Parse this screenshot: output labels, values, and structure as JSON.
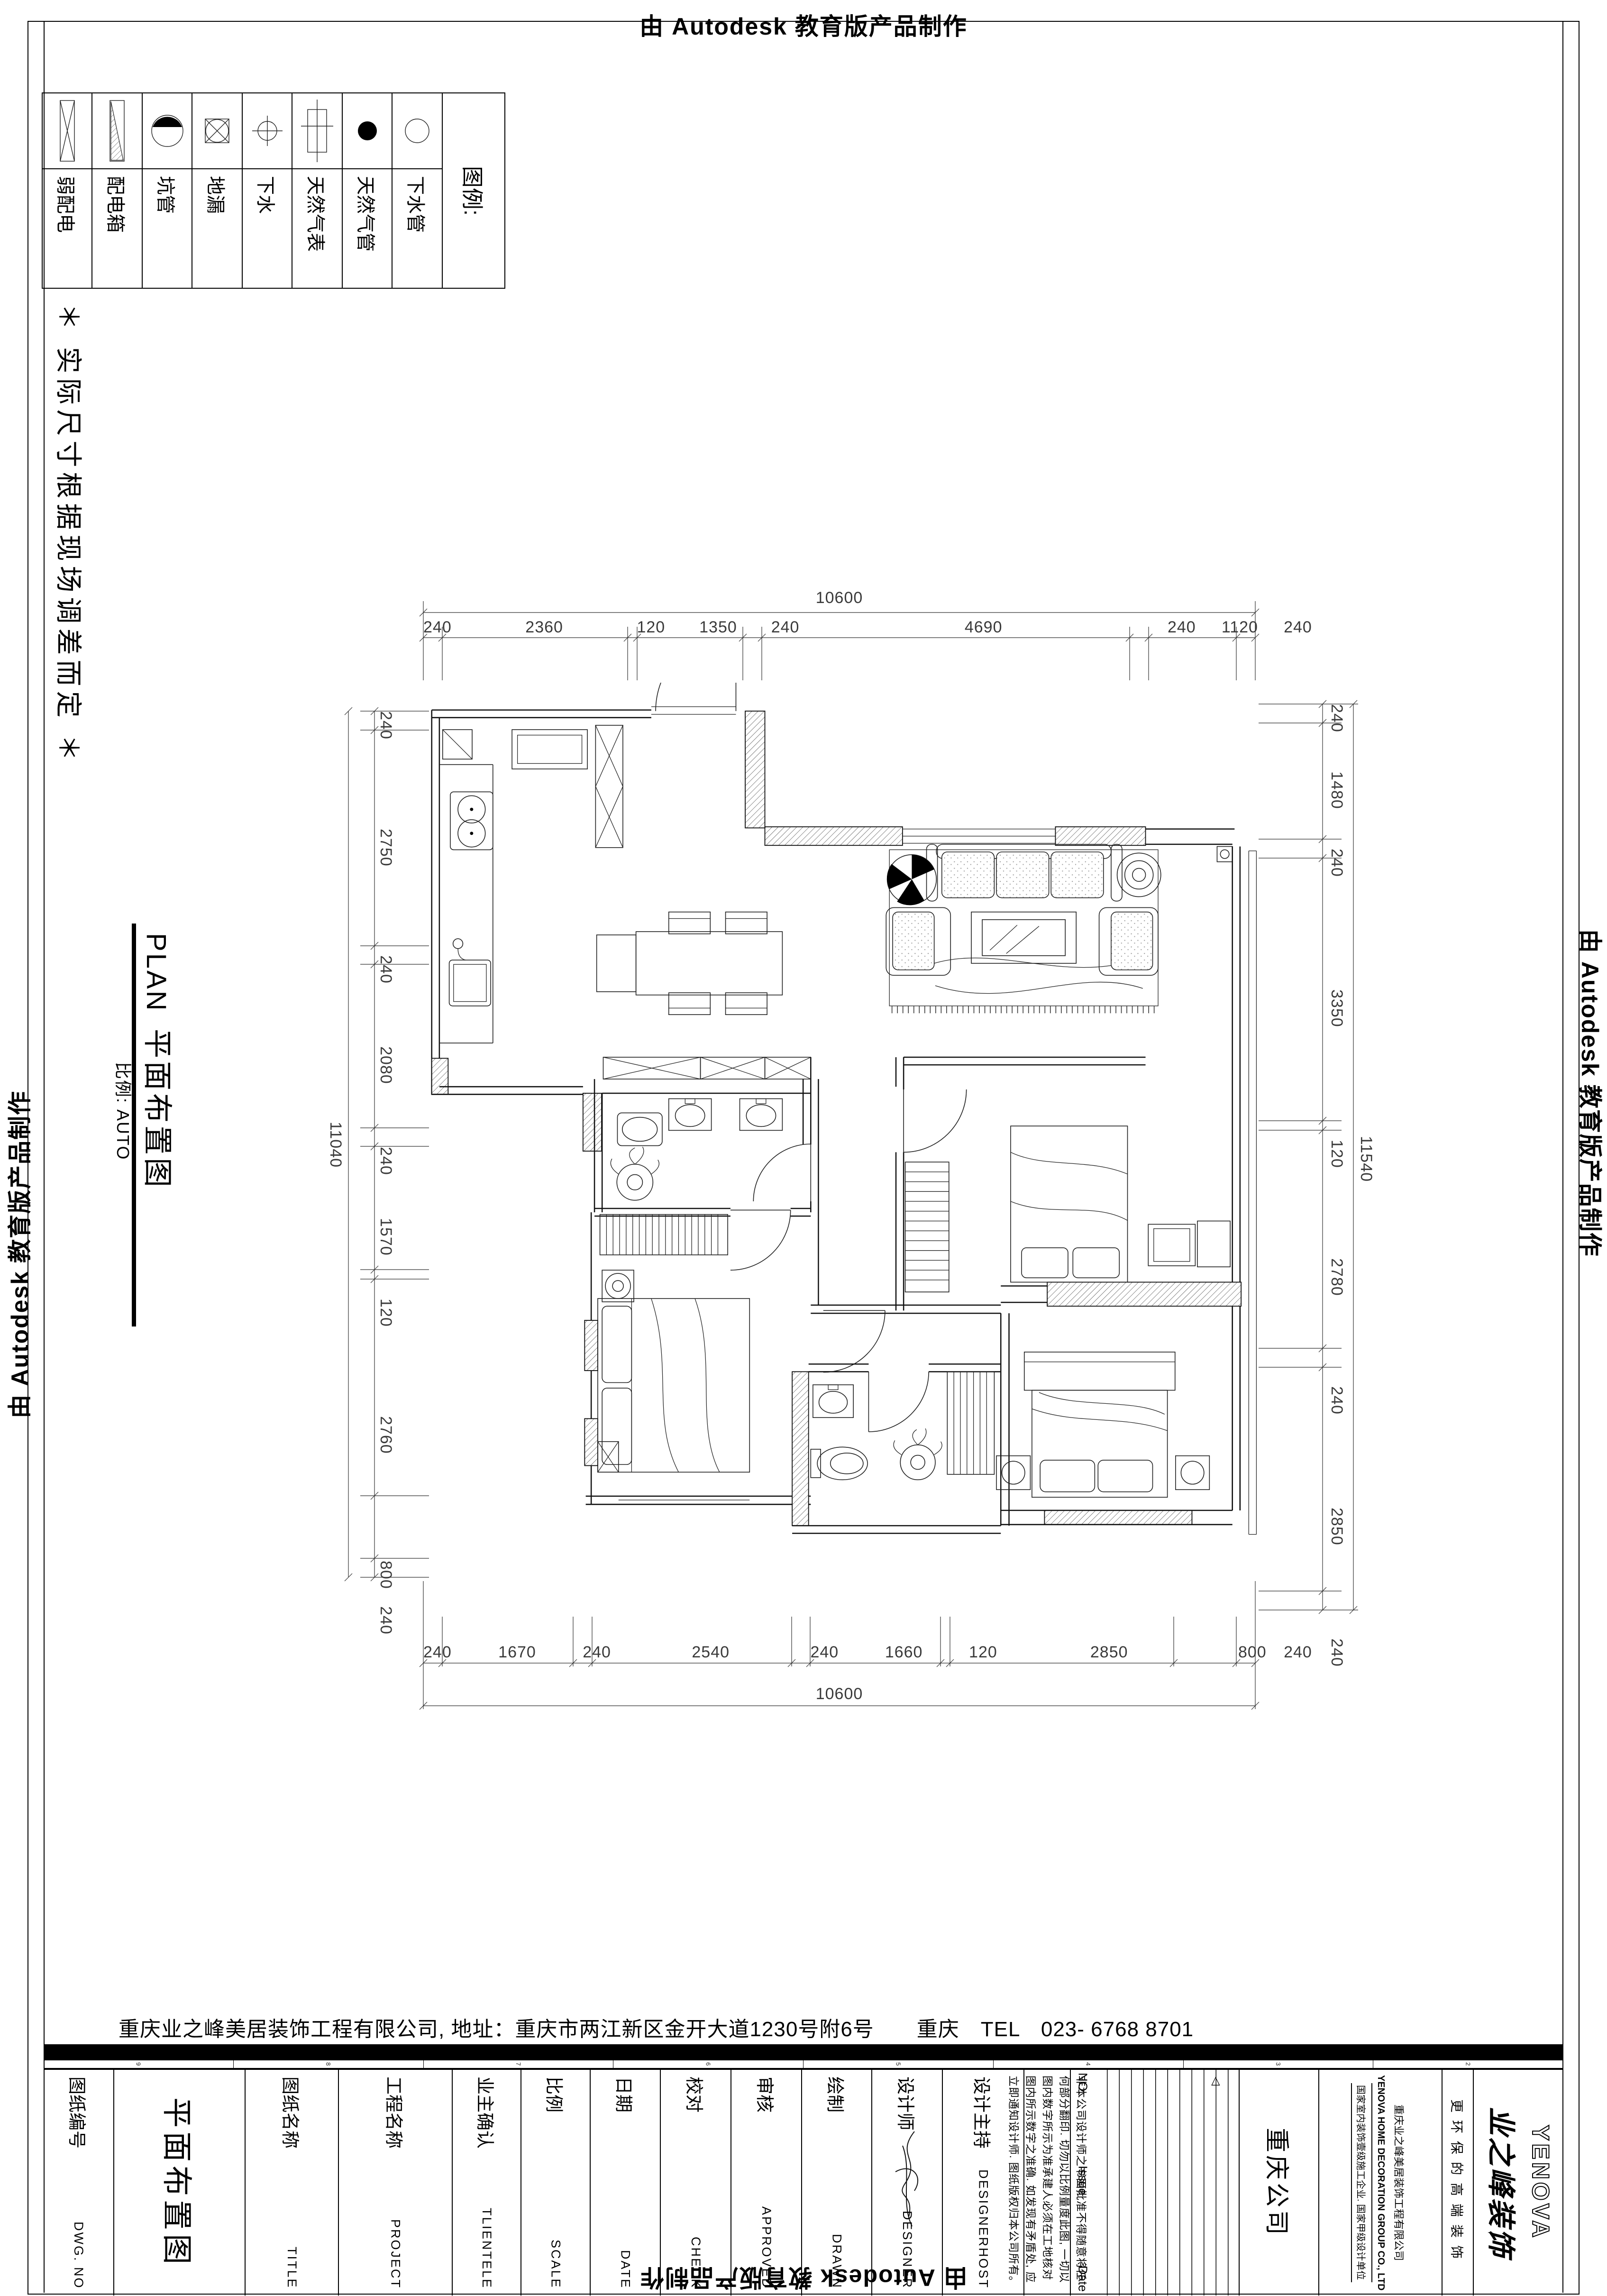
{
  "banner": {
    "text": "由 Autodesk 教育版产品制作"
  },
  "legend": {
    "title": "图例:",
    "items": [
      {
        "label": "弱配电",
        "symbol": "box-x-symbol"
      },
      {
        "label": "配电箱",
        "symbol": "box-hatch-symbol"
      },
      {
        "label": "坑管",
        "symbol": "circle-halffill-symbol"
      },
      {
        "label": "地漏",
        "symbol": "floor-drain-symbol"
      },
      {
        "label": "下水",
        "symbol": "drain-crosshair-symbol"
      },
      {
        "label": "天然气表",
        "symbol": "gas-meter-symbol"
      },
      {
        "label": "天然气管",
        "symbol": "gas-pipe-symbol"
      },
      {
        "label": "下水管",
        "symbol": "sewer-pipe-symbol"
      }
    ]
  },
  "disclaimer": "＊ 实际尺寸根据现场调差而定 ＊",
  "plan_title": {
    "en": "PLAN",
    "cn": "平面布置图",
    "scale": "比例: AUTO"
  },
  "dims": {
    "top": {
      "total": "10600",
      "segments": [
        240,
        2360,
        120,
        1350,
        240,
        4690,
        240,
        1120,
        240
      ]
    },
    "bottom": {
      "total": "10600",
      "segments": [
        240,
        1670,
        240,
        2540,
        240,
        1660,
        120,
        2850,
        800,
        240
      ]
    },
    "left": {
      "total": "11040",
      "segments": [
        240,
        2750,
        240,
        2080,
        240,
        1570,
        120,
        2760,
        800,
        240
      ]
    },
    "right": {
      "total": "11540",
      "segments": [
        240,
        1480,
        240,
        3350,
        120,
        2780,
        240,
        2850,
        240
      ]
    }
  },
  "footer": {
    "company_line": "重庆业之峰美居装饰工程有限公司, 地址：重庆市两江新区金开大道1230号附6号　　重庆　TEL　023- 6768 8701"
  },
  "titleblock": {
    "drawing_title": "平面布置图",
    "cols": [
      {
        "cn": "图纸编号",
        "en": "DWG. NO"
      },
      {
        "cn": "图纸名称",
        "en": "TITLE"
      },
      {
        "cn": "工程名称",
        "en": "PROJECT"
      },
      {
        "cn": "业主确认",
        "en": "TLIENTELE"
      },
      {
        "cn": "比例",
        "en": "SCALE"
      },
      {
        "cn": "日期",
        "en": "DATE"
      },
      {
        "cn": "校对",
        "en": "CHECK"
      },
      {
        "cn": "审核",
        "en": "APPROVED"
      },
      {
        "cn": "绘制",
        "en": "DRAWN"
      },
      {
        "cn": "设计师",
        "en": "DESIGNER"
      },
      {
        "cn": "设计主持",
        "en": "DESIGNERHOST"
      }
    ],
    "notes": "非本公司设计师之书面批准不得随意将任何部分翻印. 切勿以比例量度此图, 一切以图内数字所示为准承建人必须在工地核对图内所示数字之准确. 如发现有矛盾处, 应立即通知设计师. 图纸版权归本公司所有。",
    "revision": {
      "no": "NO.",
      "issue": "Issue",
      "date": "Date",
      "marker": "△"
    },
    "branch": "重庆公司",
    "company_small": [
      "重庆业之峰美居装饰工程有限公司",
      "YENOVA HOME DECORATION GROUP CO., LTD",
      "国家室内装饰壹级施工企业. 国家甲级设计单位"
    ],
    "slogan": "更环保的高端装饰",
    "logo_cn": "业之峰装饰",
    "logo_en": "YENOVA",
    "zone_numbers": [
      "9",
      "8",
      "7",
      "6",
      "5",
      "4",
      "3",
      "2"
    ]
  }
}
